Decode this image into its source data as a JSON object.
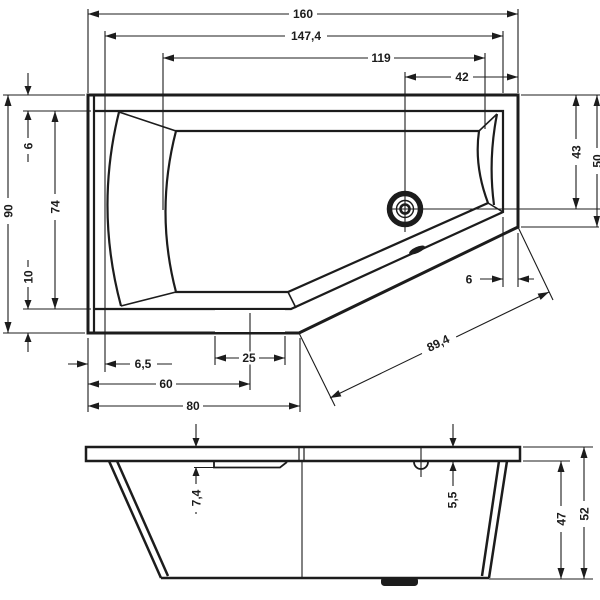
{
  "drawing": {
    "top_view": {
      "overall_length": "160",
      "inner_length": "147,4",
      "basin_length": "119",
      "drain_offset_right": "42",
      "drain_offset_top": "43",
      "corner_offset_top": "50",
      "overall_width": "90",
      "rim_top_width": "6",
      "basin_width": "74",
      "rim_bottom_width": "10",
      "rim_left_width": "6,5",
      "fitting_width": "25",
      "fitting_center_offset": "60",
      "bottom_edge_length": "80",
      "diagonal_edge_length": "89,4",
      "rim_corner_width": "6"
    },
    "front_view": {
      "recess_depth": "7,4",
      "rim_thickness": "5,5",
      "body_height": "47",
      "overall_height": "52"
    }
  }
}
